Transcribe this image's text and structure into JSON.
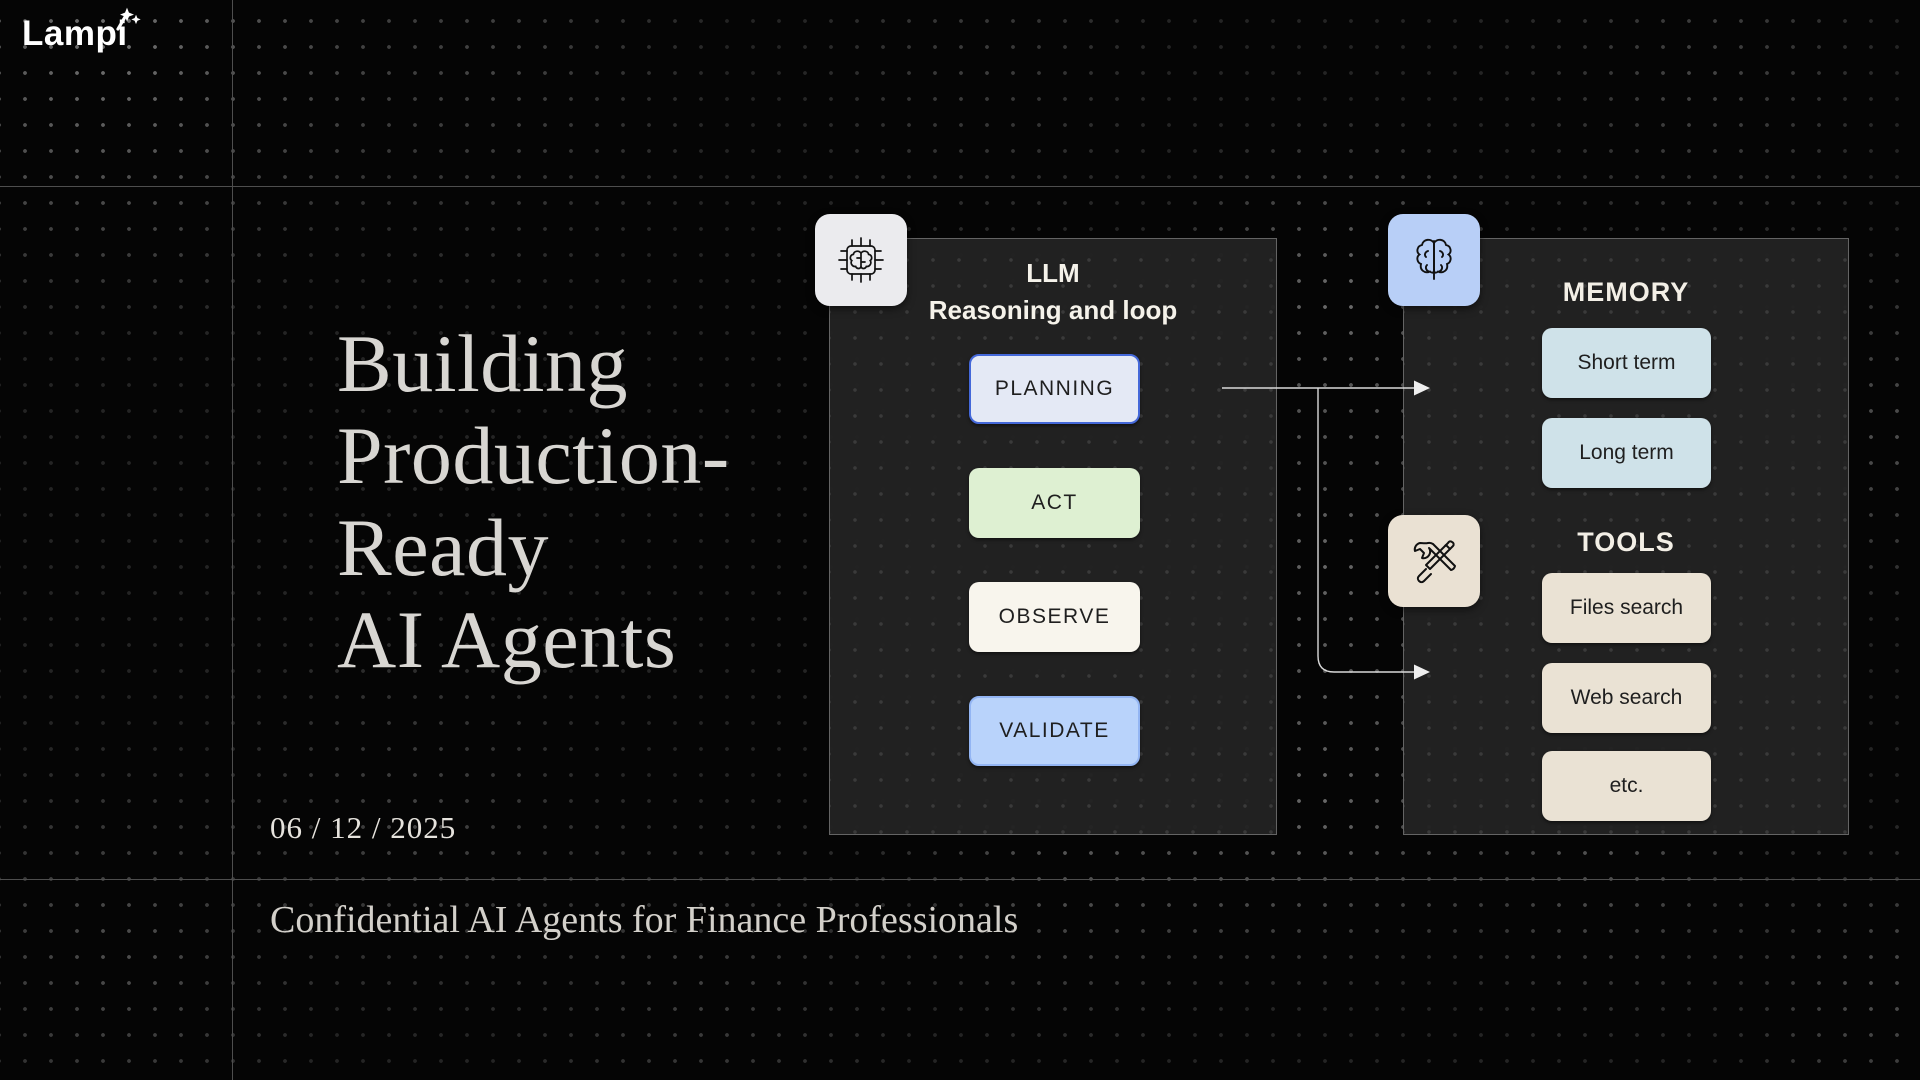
{
  "brand": {
    "logo_text": "Lampi",
    "logo_icon": "magic-wand-sparkle-icon"
  },
  "slide": {
    "title_lines": [
      "Building",
      "Production-",
      "Ready",
      "AI Agents"
    ],
    "date": "06 / 12 / 2025",
    "footer": "Confidential AI Agents for Finance Professionals"
  },
  "diagram": {
    "llm_panel": {
      "icon": "brain-chip-icon",
      "title_line1": "LLM",
      "title_line2": "Reasoning and loop",
      "steps": [
        {
          "label": "PLANNING",
          "bg": "#e4e9f5",
          "border": "#4468d9"
        },
        {
          "label": "ACT",
          "bg": "#def0d2",
          "border": "none"
        },
        {
          "label": "OBSERVE",
          "bg": "#f8f5ed",
          "border": "none"
        },
        {
          "label": "VALIDATE",
          "bg": "#b9d3fb",
          "border": "#93b5f3"
        }
      ]
    },
    "memory_tools_panel": {
      "memory": {
        "icon": "brain-icon",
        "title": "MEMORY",
        "item_bg": "#cfe2e9",
        "items": [
          {
            "label": "Short term"
          },
          {
            "label": "Long term"
          }
        ]
      },
      "tools": {
        "icon": "crossed-tools-icon",
        "title": "TOOLS",
        "item_bg": "#eae2d4",
        "items": [
          {
            "label": "Files search"
          },
          {
            "label": "Web search"
          },
          {
            "label": "etc."
          }
        ]
      }
    },
    "connectors": [
      {
        "from": "llm-panel",
        "to": "memory",
        "shape": "straight-right-arrow"
      },
      {
        "from": "llm-panel",
        "to": "tools",
        "shape": "down-then-right-arrow"
      }
    ]
  },
  "colors": {
    "page_bg": "#050505",
    "panel_bg": "#222222",
    "panel_border": "#646464",
    "grid_line": "#4e4e4e",
    "title_text": "#d8d6d2",
    "header_text": "#f5f2ea",
    "arrow": "#d9d9d9"
  }
}
